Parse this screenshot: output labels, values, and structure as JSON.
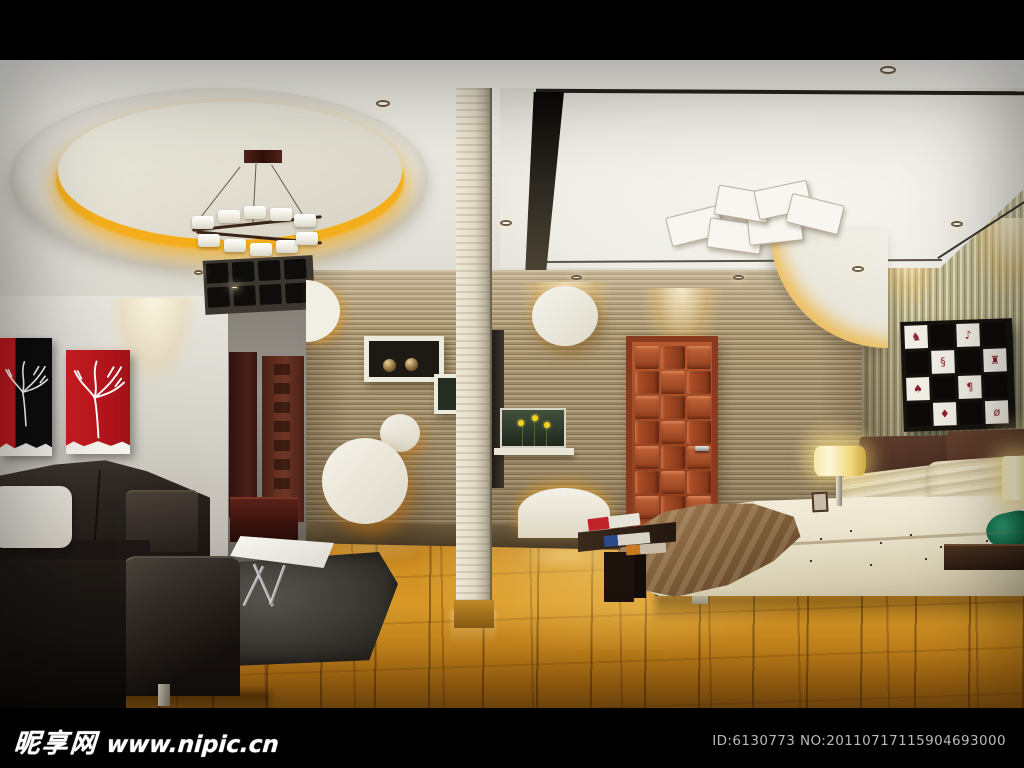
{
  "watermark_bar": {
    "site_name": "昵享网",
    "site_url": "www.nipic.cn",
    "id_label": "ID:6130773 NO:20110717115904693000"
  },
  "scene": {
    "description": "3D interior render of an open-plan modern bedroom and living room with circular ceiling cove, striped feature walls, red wood door, platform bed and black sofa"
  },
  "palette": {
    "letterbox": "#000000",
    "ceiling": "#e9e7e0",
    "cove_glow": "#f4ae1c",
    "left_wall": "#dcd9d1",
    "corridor_wall": "#8f8a83",
    "stripe_wall": "#a4906c",
    "vstripe_wall": "#b3ab80",
    "door_red": "#a8492a",
    "floor_wood": "#c8861c",
    "sofa_black": "#221d19",
    "rug_gray": "#45423e",
    "table_white": "#f1efe9",
    "duvet_cream": "#ece5d2",
    "throw_brown": "#8a6a46",
    "headboard_brown": "#4e3227",
    "green_pillow": "#177a58",
    "art_red": "#c41a20",
    "art_black": "#0d0d0d",
    "lamp_glow": "#f5d868",
    "watermark_gray": "#b9b9b9"
  },
  "patterns": {
    "door_weave": {
      "cols": 3,
      "rows": 8
    },
    "bed_artwork": {
      "cols": 4,
      "rows": 4,
      "glyphs": [
        "♞",
        "♪",
        "§",
        "♜",
        "♠",
        "¶",
        "♦",
        "ø"
      ]
    },
    "ceiling_tiles": {
      "cols": 4,
      "rows": 2
    },
    "chandelier_cubes": 10,
    "paper_panels": 6
  }
}
